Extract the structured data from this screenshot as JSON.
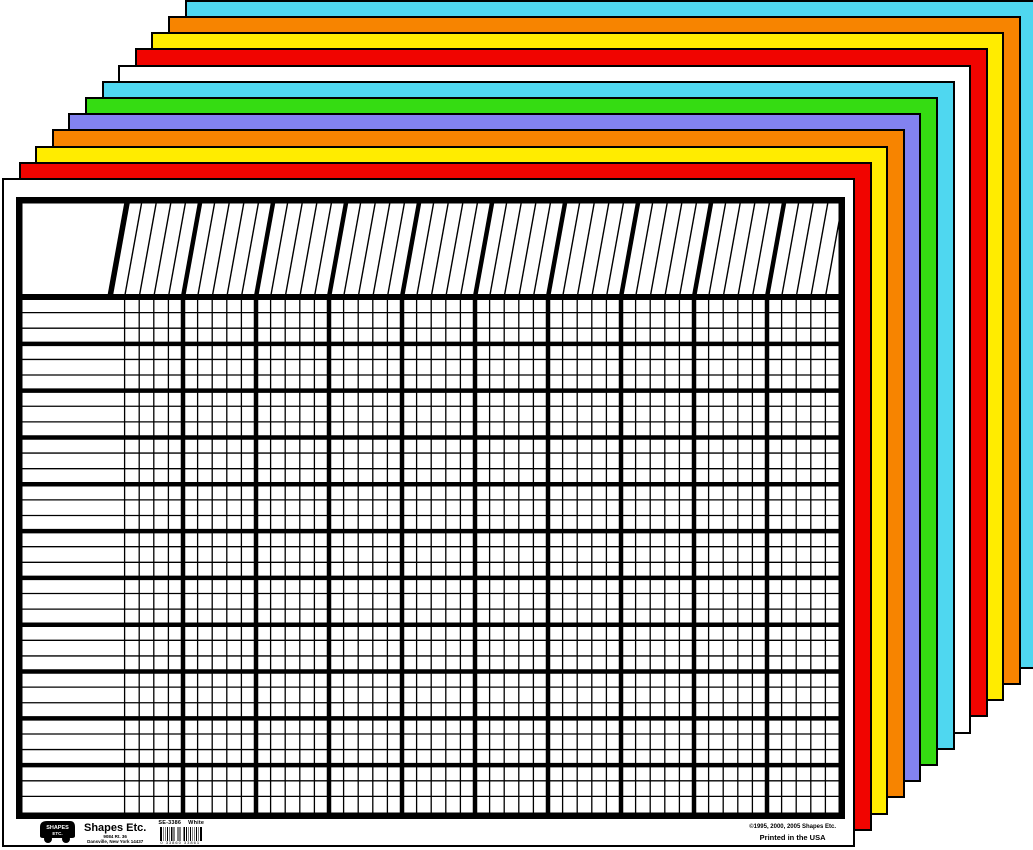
{
  "product": {
    "brand": "Shapes Etc.",
    "sku": "SE-3386",
    "color_name": "White",
    "address_line1": "9084 Rt. 36",
    "address_line2": "Dansville, New York 14437",
    "copyright_line": "©1995, 2000, 2005 Shapes Etc.",
    "printed_line": "Printed in the USA",
    "barcode_digits": "0 33860 33861"
  },
  "chart": {
    "type": "blank-incentive-grid",
    "column_groups": 10,
    "columns_per_group": 5,
    "total_columns": 50,
    "row_groups": 11,
    "rows_per_group": 3,
    "total_rows": 33,
    "header_slant_px": 17
  },
  "sheets": {
    "front_to_back": [
      "white",
      "red",
      "yellow",
      "orange",
      "purple",
      "green",
      "cyan",
      "white",
      "red",
      "yellow",
      "orange",
      "cyan"
    ]
  },
  "palette": {
    "white": "#ffffff",
    "red": "#f10400",
    "yellow": "#ffec00",
    "orange": "#f78400",
    "purple": "#8282f0",
    "green": "#35dc12",
    "cyan": "#4fd7f0",
    "outline": "#000000"
  }
}
